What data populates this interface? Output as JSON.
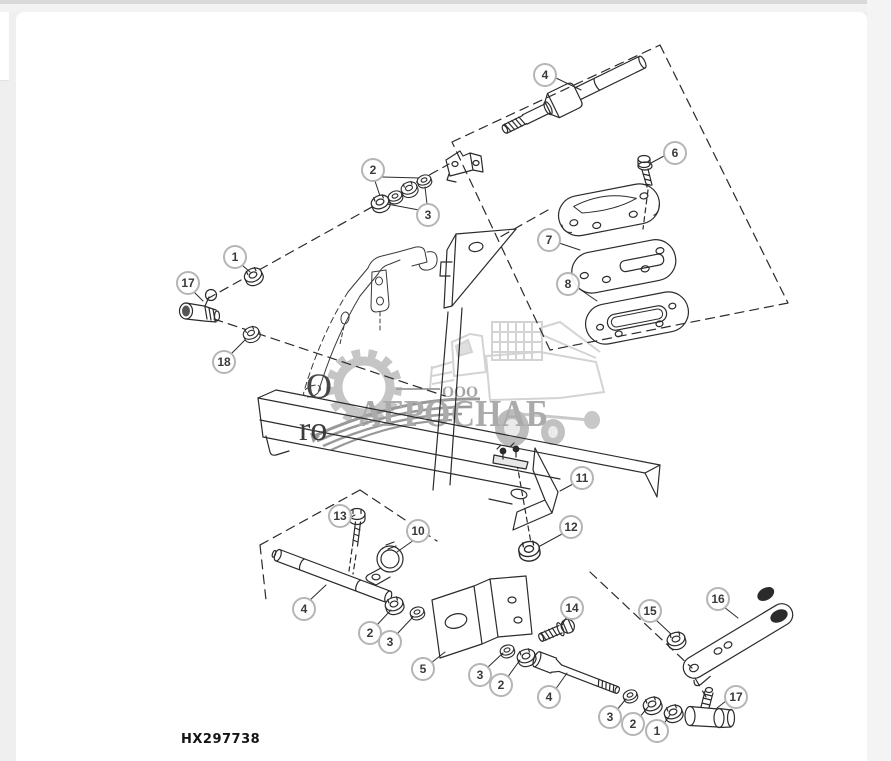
{
  "page": {
    "background_color": "#efefef",
    "panel_color": "#ffffff",
    "top_strip_color": "#d9d9d9"
  },
  "diagram": {
    "code_label": "HX297738",
    "partial_text_line1": "O",
    "partial_text_line2": "ro",
    "line_color": "#2b2b2b",
    "callout_ring_color": "#b5b5b5",
    "callout_text_color": "#3a3a3a",
    "callouts": [
      {
        "label": "4",
        "x": 545,
        "y": 75
      },
      {
        "label": "6",
        "x": 675,
        "y": 153
      },
      {
        "label": "2",
        "x": 373,
        "y": 170
      },
      {
        "label": "3",
        "x": 428,
        "y": 215
      },
      {
        "label": "1",
        "x": 235,
        "y": 257
      },
      {
        "label": "17",
        "x": 188,
        "y": 283
      },
      {
        "label": "18",
        "x": 224,
        "y": 362
      },
      {
        "label": "7",
        "x": 549,
        "y": 240
      },
      {
        "label": "8",
        "x": 568,
        "y": 284
      },
      {
        "label": "11",
        "x": 582,
        "y": 478
      },
      {
        "label": "12",
        "x": 571,
        "y": 527
      },
      {
        "label": "13",
        "x": 340,
        "y": 516
      },
      {
        "label": "10",
        "x": 418,
        "y": 531
      },
      {
        "label": "4",
        "x": 304,
        "y": 609
      },
      {
        "label": "2",
        "x": 370,
        "y": 633
      },
      {
        "label": "3",
        "x": 390,
        "y": 642
      },
      {
        "label": "5",
        "x": 423,
        "y": 669
      },
      {
        "label": "14",
        "x": 572,
        "y": 608
      },
      {
        "label": "3",
        "x": 480,
        "y": 675
      },
      {
        "label": "2",
        "x": 501,
        "y": 685
      },
      {
        "label": "4",
        "x": 549,
        "y": 697
      },
      {
        "label": "15",
        "x": 650,
        "y": 611
      },
      {
        "label": "16",
        "x": 718,
        "y": 599
      },
      {
        "label": "17",
        "x": 736,
        "y": 697
      },
      {
        "label": "3",
        "x": 610,
        "y": 717
      },
      {
        "label": "2",
        "x": 633,
        "y": 724
      },
      {
        "label": "1",
        "x": 657,
        "y": 731
      }
    ]
  },
  "watermark": {
    "company_type": "ООО",
    "company_name": "АГРОСНАБ",
    "text_color": "#a3a3a3",
    "icon_color": "#bfbfbf",
    "icons": [
      "gear-icon",
      "combine-harvester-icon",
      "leaf-spring-swoosh-icon"
    ]
  }
}
